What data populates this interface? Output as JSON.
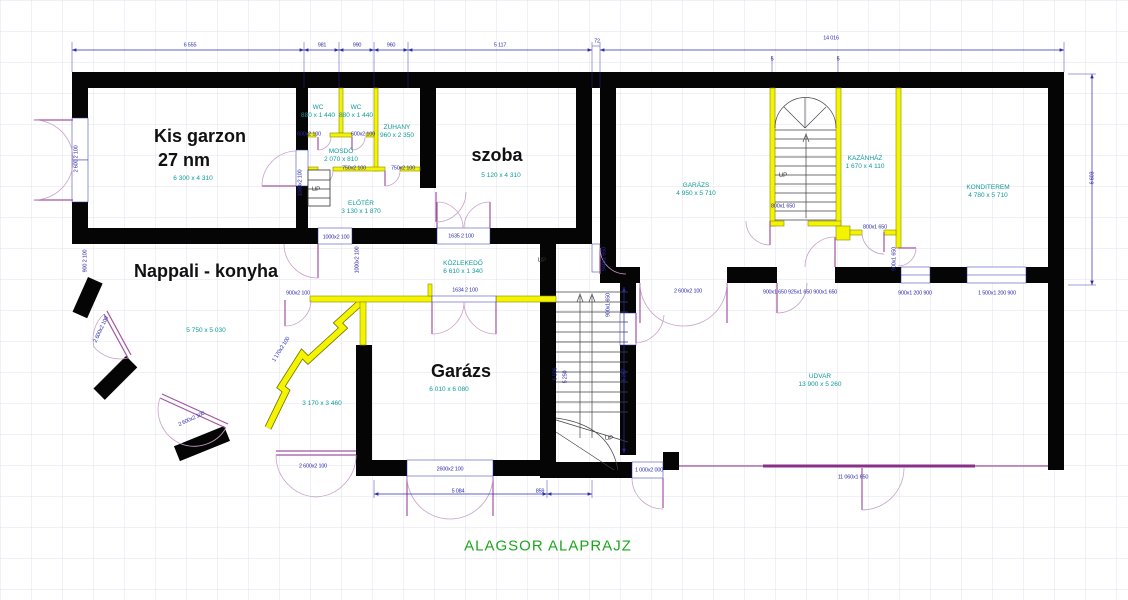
{
  "title": {
    "text": "ALAGSOR ALAPRAJZ"
  },
  "colors": {
    "wall": "#000000",
    "partition": "#f4f400",
    "door": "#a055a0",
    "dimension": "#2b2bb0",
    "room_text": "#0d9b9b",
    "title_text": "#1ea51e"
  },
  "plan": {
    "labels": [
      {
        "t": "Kis garzon",
        "x": 200,
        "y": 136,
        "c": "major",
        "n": "room-label-kis-garzon"
      },
      {
        "t": "27 nm",
        "x": 184,
        "y": 160,
        "c": "major",
        "n": "room-label-kis-garzon-area"
      },
      {
        "t": "szoba",
        "x": 497,
        "y": 155,
        "c": "major",
        "n": "room-label-szoba"
      },
      {
        "t": "Nappali - konyha",
        "x": 206,
        "y": 271,
        "c": "major",
        "n": "room-label-nappali-konyha"
      },
      {
        "t": "Garázs",
        "x": 461,
        "y": 371,
        "c": "major",
        "n": "room-label-garazs"
      },
      {
        "t": "6 300 x 4 310",
        "x": 193,
        "y": 179,
        "c": "minor",
        "n": "size-kis-garzon"
      },
      {
        "t": "5 120 x 4 310",
        "x": 501,
        "y": 176,
        "c": "minor",
        "n": "size-szoba"
      },
      {
        "t": "5 750 x 5 030",
        "x": 206,
        "y": 331,
        "c": "minor",
        "n": "size-nappali"
      },
      {
        "t": "6 010 x 6 080",
        "x": 449,
        "y": 390,
        "c": "minor",
        "n": "size-garazs"
      },
      {
        "t": "WC",
        "x": 318,
        "y": 108,
        "c": "minor",
        "n": "room-label-wc-1"
      },
      {
        "t": "880 x 1 440",
        "x": 318,
        "y": 116,
        "c": "minor",
        "n": "size-wc-1"
      },
      {
        "t": "WC",
        "x": 356,
        "y": 108,
        "c": "minor",
        "n": "room-label-wc-2"
      },
      {
        "t": "880 x 1 440",
        "x": 356,
        "y": 116,
        "c": "minor",
        "n": "size-wc-2"
      },
      {
        "t": "ZUHANY",
        "x": 397,
        "y": 128,
        "c": "minor",
        "n": "room-label-zuhany"
      },
      {
        "t": "960 x 2 350",
        "x": 397,
        "y": 136,
        "c": "minor",
        "n": "size-zuhany"
      },
      {
        "t": "MOSDÓ",
        "x": 341,
        "y": 152,
        "c": "minor",
        "n": "room-label-mosdo"
      },
      {
        "t": "2 070 x 810",
        "x": 341,
        "y": 160,
        "c": "minor",
        "n": "size-mosdo"
      },
      {
        "t": "ELŐTÉR",
        "x": 361,
        "y": 204,
        "c": "minor",
        "n": "room-label-eloter"
      },
      {
        "t": "3 130 x 1 870",
        "x": 361,
        "y": 212,
        "c": "minor",
        "n": "size-eloter"
      },
      {
        "t": "KÖZLEKEDŐ",
        "x": 463,
        "y": 264,
        "c": "minor",
        "n": "room-label-kozlekedo"
      },
      {
        "t": "6 610 x 1 340",
        "x": 463,
        "y": 272,
        "c": "minor",
        "n": "size-kozlekedo"
      },
      {
        "t": "GARÁZS",
        "x": 696,
        "y": 186,
        "c": "minor",
        "n": "room-label-garazs-upper"
      },
      {
        "t": "4 950 x 5 710",
        "x": 696,
        "y": 194,
        "c": "minor",
        "n": "size-garazs-upper"
      },
      {
        "t": "KAZÁNHÁZ",
        "x": 865,
        "y": 159,
        "c": "minor",
        "n": "room-label-kazanhaz"
      },
      {
        "t": "1 670 x 4 110",
        "x": 865,
        "y": 167,
        "c": "minor",
        "n": "size-kazanhaz"
      },
      {
        "t": "KONDITEREM",
        "x": 988,
        "y": 188,
        "c": "minor",
        "n": "room-label-konditerem"
      },
      {
        "t": "4 780 x 5 710",
        "x": 988,
        "y": 196,
        "c": "minor",
        "n": "size-konditerem"
      },
      {
        "t": "UDVAR",
        "x": 820,
        "y": 377,
        "c": "minor",
        "n": "room-label-udvar"
      },
      {
        "t": "13 900 x 5 260",
        "x": 820,
        "y": 385,
        "c": "minor",
        "n": "size-udvar"
      },
      {
        "t": "3 170 x 3 460",
        "x": 322,
        "y": 404,
        "c": "minor",
        "n": "size-diagonal-area"
      },
      {
        "t": "6 555",
        "x": 190,
        "y": 46,
        "c": "dim"
      },
      {
        "t": "981",
        "x": 322,
        "y": 46,
        "c": "dim"
      },
      {
        "t": "990",
        "x": 357,
        "y": 46,
        "c": "dim"
      },
      {
        "t": "960",
        "x": 391,
        "y": 46,
        "c": "dim"
      },
      {
        "t": "5 117",
        "x": 500,
        "y": 46,
        "c": "dim"
      },
      {
        "t": "72",
        "x": 597,
        "y": 42,
        "c": "dim"
      },
      {
        "t": "14 016",
        "x": 831,
        "y": 39,
        "c": "dim"
      },
      {
        "t": "5",
        "x": 772,
        "y": 60,
        "c": "dim"
      },
      {
        "t": "5",
        "x": 838,
        "y": 60,
        "c": "dim"
      },
      {
        "t": "6 603",
        "x": 1093,
        "y": 178,
        "c": "dim",
        "r": -90
      },
      {
        "t": "5 257",
        "x": 625,
        "y": 375,
        "c": "dim",
        "r": -90
      },
      {
        "t": "6 506",
        "x": 556,
        "y": 374,
        "c": "dim",
        "r": -90
      },
      {
        "t": "5 250",
        "x": 566,
        "y": 377,
        "c": "dim",
        "r": -90
      },
      {
        "t": "5 084",
        "x": 458,
        "y": 492,
        "c": "dim"
      },
      {
        "t": "859",
        "x": 540,
        "y": 492,
        "c": "dim"
      },
      {
        "t": "2600x2 100",
        "x": 450,
        "y": 470,
        "c": "dim"
      },
      {
        "t": "1 000x2 000",
        "x": 649,
        "y": 471,
        "c": "dim"
      },
      {
        "t": "11 060x1 650",
        "x": 853,
        "y": 478,
        "c": "dim"
      },
      {
        "t": "1000x2 100",
        "x": 336,
        "y": 238,
        "c": "dim"
      },
      {
        "t": "1635 2 100",
        "x": 461,
        "y": 237,
        "c": "dim"
      },
      {
        "t": "1634 2 100",
        "x": 465,
        "y": 291,
        "c": "dim"
      },
      {
        "t": "900x2 100",
        "x": 298,
        "y": 294,
        "c": "dim"
      },
      {
        "t": "1000x2 100",
        "x": 301,
        "y": 183,
        "c": "dim",
        "r": -90
      },
      {
        "t": "1000x2 100",
        "x": 358,
        "y": 260,
        "c": "dim",
        "r": -90
      },
      {
        "t": "600x2 100",
        "x": 309,
        "y": 135,
        "c": "dim"
      },
      {
        "t": "600x2 100",
        "x": 363,
        "y": 135,
        "c": "dim"
      },
      {
        "t": "750x2 100",
        "x": 354,
        "y": 169,
        "c": "dim"
      },
      {
        "t": "750x2 100",
        "x": 403,
        "y": 169,
        "c": "dim"
      },
      {
        "t": "2 600x2 100",
        "x": 102,
        "y": 330,
        "c": "dim",
        "r": -65
      },
      {
        "t": "2 600x2 100",
        "x": 192,
        "y": 420,
        "c": "dim",
        "r": -25
      },
      {
        "t": "2 600x2 100",
        "x": 313,
        "y": 467,
        "c": "dim"
      },
      {
        "t": "2 600 2 100",
        "x": 77,
        "y": 159,
        "c": "dim",
        "r": -90
      },
      {
        "t": "900 2 100",
        "x": 86,
        "y": 261,
        "c": "dim",
        "r": -90
      },
      {
        "t": "1 170x2 100",
        "x": 282,
        "y": 350,
        "c": "dim",
        "r": -58
      },
      {
        "t": "940x1 650",
        "x": 605,
        "y": 259,
        "c": "dim",
        "r": -90
      },
      {
        "t": "900x1 650",
        "x": 609,
        "y": 305,
        "c": "dim",
        "r": -90
      },
      {
        "t": "900x1 650 925x1 650 900x1 650",
        "x": 800,
        "y": 293,
        "c": "dim"
      },
      {
        "t": "900x1 200 900",
        "x": 915,
        "y": 294,
        "c": "dim"
      },
      {
        "t": "1 500x1 200 900",
        "x": 997,
        "y": 294,
        "c": "dim"
      },
      {
        "t": "2 600x2 100",
        "x": 688,
        "y": 292,
        "c": "dim"
      },
      {
        "t": "800x1 650",
        "x": 875,
        "y": 228,
        "c": "dim"
      },
      {
        "t": "800x1 650",
        "x": 783,
        "y": 207,
        "c": "dim"
      },
      {
        "t": "900x1 650",
        "x": 895,
        "y": 259,
        "c": "dim",
        "r": -90
      },
      {
        "t": "UP",
        "x": 316,
        "y": 190,
        "c": "up",
        "n": "up-label-entry-stair"
      },
      {
        "t": "UP",
        "x": 783,
        "y": 176,
        "c": "up",
        "n": "up-label-right-stair"
      },
      {
        "t": "UP",
        "x": 542,
        "y": 261,
        "c": "up",
        "n": "up-label-center-stair-top"
      },
      {
        "t": "UP",
        "x": 609,
        "y": 439,
        "c": "up",
        "n": "up-label-center-stair-bottom"
      }
    ]
  }
}
